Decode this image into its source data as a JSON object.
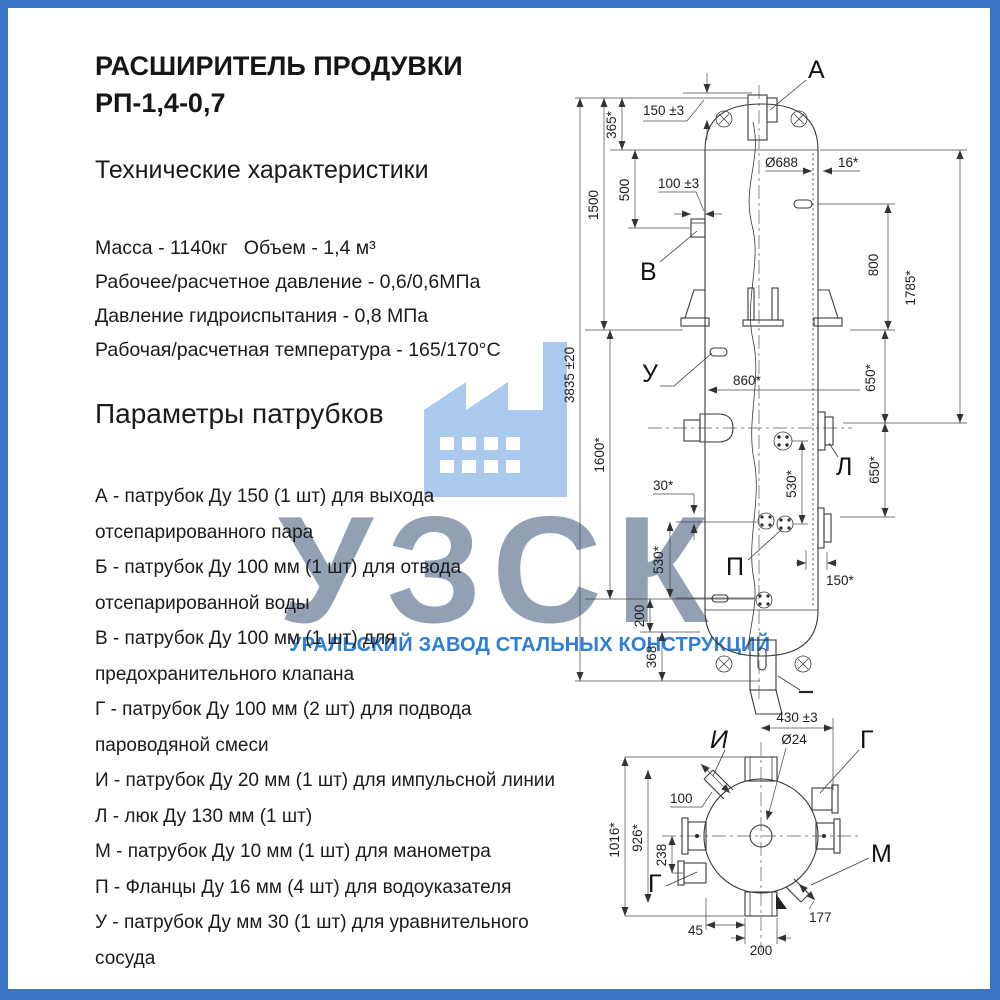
{
  "page": {
    "border_color": "#3B74C5",
    "background": "#FFFFFF"
  },
  "header": {
    "title_line1": "РАСШИРИТЕЛЬ ПРОДУВКИ",
    "title_line2": "РП-1,4-0,7"
  },
  "specs": {
    "heading": "Технические характеристики",
    "lines": [
      "Масса - 1140кг   Объем - 1,4 м³",
      "Рабочее/расчетное давление - 0,6/0,6МПа",
      "Давление гидроиспытания - 0,8 МПа",
      "Рабочая/расчетная температура - 165/170°С"
    ]
  },
  "nozzles": {
    "heading": "Параметры патрубков",
    "items": [
      "А - патрубок Ду 150 (1 шт) для выхода\nотсепарированного пара",
      "Б - патрубок Ду 100 мм (1 шт) для отвода\nотсепарированной воды",
      "В - патрубок Ду 100 мм (1 шт) для\nпредохранительного клапана",
      "Г - патрубок Ду 100 мм (2 шт) для подвода\nпароводяной смеси",
      "И - патрубок Ду 20 мм (1 шт) для импульсной линии",
      "Л - люк Ду 130 мм (1 шт)",
      "М - патрубок Ду 10 мм (1 шт) для манометра",
      "П - Фланцы Ду 16 мм (4 шт) для водоуказателя",
      "У - патрубок Ду мм 30 (1 шт) для уравнительного\nсосуда"
    ]
  },
  "watermark": {
    "letters": "УЗСК",
    "caption": "УРАЛЬСКИЙ ЗАВОД СТАЛЬНЫХ КОНСТРУКЦИЙ",
    "icon": "factory-icon",
    "letters_color": "#8D9BAF",
    "caption_color": "#2E7DD6",
    "icon_color": "#ABC9ED"
  },
  "drawing": {
    "labels": {
      "a": "А",
      "v": "В",
      "u": "У",
      "l": "Л",
      "p": "П",
      "i": "И",
      "g_top": "Г",
      "g_bottom": "Г",
      "m": "М"
    },
    "dims": {
      "d150_3": "150 ±3",
      "d365": "365*",
      "d100_3": "100 ±3",
      "d500": "500",
      "d1500": "1500",
      "d3835": "3835 ±20",
      "d688": "Ø688",
      "d16": "16*",
      "d800": "800",
      "d1785": "1785*",
      "d650a": "650*",
      "d650b": "650*",
      "d1600": "1600*",
      "d860": "860*",
      "d30": "30*",
      "d530a": "530*",
      "d530b": "530*",
      "d150r": "150*",
      "d200": "200",
      "d368": "368",
      "b430": "430 ±3",
      "b24": "Ø24",
      "b100": "100",
      "b1016": "1016*",
      "b926": "926*",
      "b238": "238",
      "b45": "45",
      "b200": "200",
      "b177": "177"
    }
  }
}
